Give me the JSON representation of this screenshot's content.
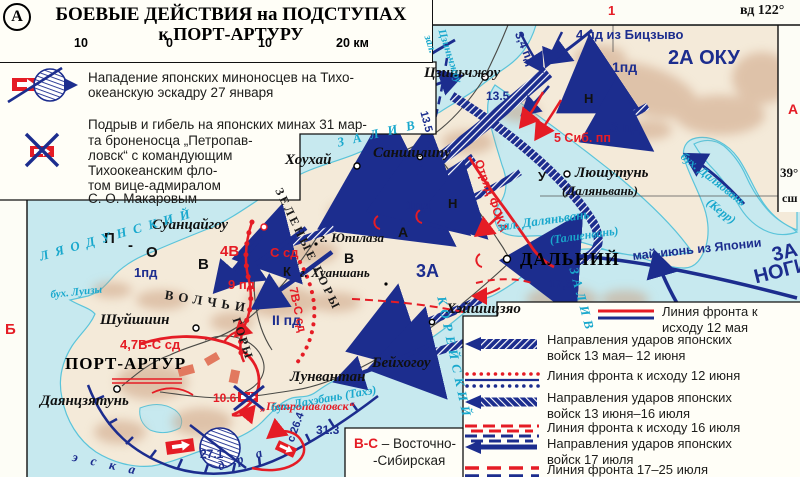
{
  "colors": {
    "red": "#e51c25",
    "navy": "#1c2d8e",
    "cyan": "#19a8cd",
    "water": "#c7e9ef",
    "land": "#f4ead9",
    "relief": "#c99b7a",
    "box": "#fffef7"
  },
  "margins": {
    "top_number": "1",
    "longitude": "вд 122°",
    "right_letter": "А",
    "left_letter": "Б",
    "lat_deg": "39°",
    "lat_dir": "сш"
  },
  "title_box": {
    "badge": "А",
    "line1": "БОЕВЫЕ ДЕЙСТВИЯ на ПОДСТУПАХ",
    "line2": "к ПОРТ-АРТУРУ",
    "scale_ticks": [
      "10",
      "0",
      "10",
      "20 км"
    ]
  },
  "events_box": {
    "items": [
      {
        "icon": "torpedo-attack-icon",
        "lines": [
          "Нападение японских миноносцев на Тихо-",
          "океанскую эскадру 27 января"
        ]
      },
      {
        "icon": "mine-loss-icon",
        "lines": [
          "Подрыв и гибель на японских минах 31 мар-",
          "та броненосца „Петропав-",
          "ловск“ с командующим",
          "Тихоокеанским фло-",
          "том вице-адмиралом",
          "С. О. Макаровым"
        ]
      }
    ]
  },
  "map_labels": [
    {
      "name": "label-4pd-bitszyvo",
      "text": "4 пд из Бицзыво",
      "x": 576,
      "y": 28,
      "cls": "ub",
      "size": 13
    },
    {
      "name": "label-34pd",
      "text": "3,4 пд",
      "x": 524,
      "y": 30,
      "cls": "ub",
      "size": 12,
      "rot": 68
    },
    {
      "name": "label-1pd-north",
      "text": "1пд",
      "x": 612,
      "y": 60,
      "cls": "ub",
      "size": 14
    },
    {
      "name": "label-2a-oku",
      "text": "2А ОКУ",
      "x": 668,
      "y": 48,
      "cls": "ub",
      "size": 20
    },
    {
      "name": "label-3pd",
      "text": "3 пд",
      "x": 610,
      "y": 120,
      "cls": "ub",
      "size": 15
    },
    {
      "name": "label-date-135a",
      "text": "13.5",
      "x": 486,
      "y": 90,
      "cls": "ub",
      "size": 12
    },
    {
      "name": "label-date-135b",
      "text": "13.5",
      "x": 428,
      "y": 110,
      "cls": "ub",
      "size": 11,
      "rot": 75
    },
    {
      "name": "label-1pd-center",
      "text": "1пд",
      "x": 406,
      "y": 198,
      "cls": "ub",
      "size": 14
    },
    {
      "name": "label-3a-center",
      "text": "3А",
      "x": 416,
      "y": 262,
      "cls": "ub",
      "size": 18
    },
    {
      "name": "label-2pd",
      "text": "II пд",
      "x": 272,
      "y": 313,
      "cls": "ub",
      "size": 14
    },
    {
      "name": "label-1pd-west",
      "text": "1пд",
      "x": 134,
      "y": 266,
      "cls": "ub",
      "size": 13
    },
    {
      "name": "label-date-175",
      "text": "17,5",
      "x": 549,
      "y": 278,
      "cls": "ub",
      "size": 12
    },
    {
      "name": "label-date-313",
      "text": "31.3",
      "x": 316,
      "y": 424,
      "cls": "ub",
      "size": 12
    },
    {
      "name": "label-date-271",
      "text": "27.1",
      "x": 200,
      "y": 448,
      "cls": "ub",
      "size": 12
    },
    {
      "name": "label-may-june-japan",
      "text": "май-июнь из Японии",
      "x": 632,
      "y": 250,
      "cls": "ub",
      "size": 12.5,
      "rot": -6
    },
    {
      "name": "label-3a-nogi-1",
      "text": "3А",
      "x": 770,
      "y": 246,
      "cls": "ub",
      "size": 20,
      "rot": -14
    },
    {
      "name": "label-3a-nogi-2",
      "text": "НОГИ",
      "x": 752,
      "y": 268,
      "cls": "ub",
      "size": 20,
      "rot": -14
    },
    {
      "name": "label-s264",
      "text": "с 26.4",
      "x": 286,
      "y": 440,
      "cls": "ub",
      "size": 11,
      "rot": -70
    },
    {
      "name": "label-eskadra-1",
      "text": "э с к а",
      "x": 74,
      "y": 450,
      "cls": "wnavy",
      "size": 13,
      "rot": 12,
      "ls": 5
    },
    {
      "name": "label-eskadra-2",
      "text": "д р а",
      "x": 216,
      "y": 460,
      "cls": "wnavy",
      "size": 13,
      "rot": -18,
      "ls": 5
    },
    {
      "name": "label-5sib",
      "text": "5 Сиб. пп",
      "x": 554,
      "y": 132,
      "cls": "ur",
      "size": 12.5
    },
    {
      "name": "label-otryad-foka",
      "text": "Отряд ФОКА",
      "x": 484,
      "y": 158,
      "cls": "ur",
      "size": 12,
      "rot": 70
    },
    {
      "name": "label-4v",
      "text": "4В",
      "x": 220,
      "y": 244,
      "cls": "ur",
      "size": 15
    },
    {
      "name": "label-ssd",
      "text": "С сд",
      "x": 270,
      "y": 246,
      "cls": "ur",
      "size": 13
    },
    {
      "name": "label-7v-ssd",
      "text": "7В-С сд",
      "x": 299,
      "y": 286,
      "cls": "ur",
      "size": 12,
      "rot": 78
    },
    {
      "name": "label-47v-ssd",
      "text": "4,7В-С сд",
      "x": 120,
      "y": 338,
      "cls": "ur",
      "size": 13
    },
    {
      "name": "label-9pd",
      "text": "9 пд",
      "x": 228,
      "y": 278,
      "cls": "ur",
      "size": 13
    },
    {
      "name": "label-date-106",
      "text": "10.6",
      "x": 213,
      "y": 392,
      "cls": "ur",
      "size": 12
    },
    {
      "name": "label-petropavlovsk",
      "text": "„Петропавловск“",
      "x": 260,
      "y": 400,
      "cls": "uri",
      "size": 12
    },
    {
      "name": "label-tszinchzhou",
      "text": "Цзиньчжоу",
      "x": 424,
      "y": 66,
      "cls": "town",
      "size": 15
    },
    {
      "name": "label-houhai",
      "text": "Хоухай",
      "x": 285,
      "y": 153,
      "cls": "town",
      "size": 15
    },
    {
      "name": "label-sanshilipu",
      "text": "Саншилипу",
      "x": 373,
      "y": 146,
      "cls": "town",
      "size": 15
    },
    {
      "name": "label-lyushutun",
      "text": "Люшутунь",
      "x": 575,
      "y": 166,
      "cls": "town",
      "size": 15
    },
    {
      "name": "label-dalyanvan-alt",
      "text": "(Даляньвань)",
      "x": 562,
      "y": 184,
      "cls": "town",
      "size": 13
    },
    {
      "name": "label-dalny",
      "text": "ДАЛЬНИЙ",
      "x": 520,
      "y": 250,
      "cls": "city",
      "size": 18
    },
    {
      "name": "label-kheyshitszyao",
      "text": "Хэйшицзяо",
      "x": 446,
      "y": 302,
      "cls": "town",
      "size": 15
    },
    {
      "name": "label-beykhogou",
      "text": "Бейхогоу",
      "x": 372,
      "y": 356,
      "cls": "town",
      "size": 15
    },
    {
      "name": "label-lunvantan",
      "text": "Лунвантан",
      "x": 290,
      "y": 370,
      "cls": "town",
      "size": 15
    },
    {
      "name": "label-suantsaygou",
      "text": "Суанцайгоу",
      "x": 152,
      "y": 218,
      "cls": "town",
      "size": 15
    },
    {
      "name": "label-shuyshiin",
      "text": "Шуйшиин",
      "x": 100,
      "y": 313,
      "cls": "town",
      "size": 15
    },
    {
      "name": "label-port-artur",
      "text": "ПОРТ-АРТУР",
      "x": 65,
      "y": 355,
      "cls": "city",
      "size": 17
    },
    {
      "name": "label-dayantszyatun",
      "text": "Даянцзятунь",
      "x": 40,
      "y": 394,
      "cls": "town",
      "size": 15
    },
    {
      "name": "label-yupilaza",
      "text": "г. Юпилаза",
      "x": 320,
      "y": 231,
      "cls": "town",
      "size": 13
    },
    {
      "name": "label-khuanshan",
      "text": "г. Хуаншань",
      "x": 300,
      "y": 266,
      "cls": "town",
      "size": 13
    },
    {
      "name": "label-letter-n1",
      "text": "Н",
      "x": 584,
      "y": 92,
      "cls": "blk",
      "size": 13
    },
    {
      "name": "label-letter-u",
      "text": "У",
      "x": 538,
      "y": 170,
      "cls": "blk",
      "size": 13
    },
    {
      "name": "label-letter-n2",
      "text": "Н",
      "x": 448,
      "y": 197,
      "cls": "blk",
      "size": 13
    },
    {
      "name": "label-letter-a",
      "text": "А",
      "x": 398,
      "y": 225,
      "cls": "blk",
      "size": 14
    },
    {
      "name": "label-letter-v",
      "text": "В",
      "x": 344,
      "y": 251,
      "cls": "blk",
      "size": 14
    },
    {
      "name": "label-letter-k",
      "text": "К",
      "x": 283,
      "y": 265,
      "cls": "blk",
      "size": 13
    },
    {
      "name": "label-pov-p",
      "text": "П",
      "x": 104,
      "y": 231,
      "cls": "blk",
      "size": 15
    },
    {
      "name": "label-pov-dash",
      "text": "-",
      "x": 128,
      "y": 238,
      "cls": "blk",
      "size": 15
    },
    {
      "name": "label-pov-o",
      "text": "О",
      "x": 146,
      "y": 245,
      "cls": "blk",
      "size": 15
    },
    {
      "name": "label-pov-v",
      "text": "В",
      "x": 198,
      "y": 257,
      "cls": "blk",
      "size": 15
    },
    {
      "name": "label-volchi",
      "text": "ВОЛЧЬИ",
      "x": 166,
      "y": 288,
      "cls": "mtn",
      "size": 13,
      "rot": 9,
      "ls": 5
    },
    {
      "name": "label-gory",
      "text": "ГОРЫ",
      "x": 242,
      "y": 316,
      "cls": "mtn",
      "size": 12,
      "rot": 72,
      "ls": 2
    },
    {
      "name": "label-zelenye-gory",
      "text": "ЗЕЛЕНЫЕ ГОРЫ",
      "x": 284,
      "y": 186,
      "cls": "mtn",
      "size": 12,
      "rot": 64,
      "ls": 3
    },
    {
      "name": "label-zal-tszinchzhou-1",
      "text": "зал.",
      "x": 432,
      "y": 34,
      "cls": "water",
      "size": 11,
      "rot": 72
    },
    {
      "name": "label-zal-tszinchzhou-2",
      "text": "Цзиньчжоу",
      "x": 446,
      "y": 28,
      "cls": "water",
      "size": 11,
      "rot": 72
    },
    {
      "name": "label-zaliv-liaodun",
      "text": "ЗАЛИВ",
      "x": 336,
      "y": 136,
      "cls": "water",
      "size": 13,
      "rot": -13,
      "ls": 9
    },
    {
      "name": "label-lyaodunskiy",
      "text": "ЛЯОДУНСКИЙ",
      "x": 38,
      "y": 250,
      "cls": "water",
      "size": 13,
      "rot": -16,
      "ls": 7
    },
    {
      "name": "label-bukh-luizy",
      "text": "бух. Луизы",
      "x": 50,
      "y": 290,
      "cls": "water",
      "size": 11,
      "rot": -6
    },
    {
      "name": "label-zal-dalyanvan",
      "text": "зал. Даляньвань",
      "x": 497,
      "y": 220,
      "cls": "water",
      "size": 13,
      "rot": -8
    },
    {
      "name": "label-talienvan",
      "text": "(Талиенвань)",
      "x": 549,
      "y": 234,
      "cls": "water",
      "size": 12,
      "rot": -8
    },
    {
      "name": "label-bukh-dalyaovan",
      "text": "бух. Даляовань",
      "x": 686,
      "y": 150,
      "cls": "water",
      "size": 12,
      "rot": 38
    },
    {
      "name": "label-kerr",
      "text": "(Керр)",
      "x": 712,
      "y": 196,
      "cls": "water",
      "size": 12,
      "rot": 38
    },
    {
      "name": "label-bukh-dakhebani",
      "text": "бух. Дахэбань (Тахэ)",
      "x": 270,
      "y": 402,
      "cls": "water",
      "size": 12,
      "rot": -10
    },
    {
      "name": "label-koreyskiy",
      "text": "КОРЕЙСКИЙ",
      "x": 448,
      "y": 295,
      "cls": "water",
      "size": 13,
      "rot": 78,
      "ls": 5
    },
    {
      "name": "label-zaliv-korea",
      "text": "ЗАЛИВ",
      "x": 580,
      "y": 266,
      "cls": "water",
      "size": 13,
      "rot": 75,
      "ls": 5
    }
  ],
  "legend_box": {
    "items": [
      {
        "symbol": "front-solid",
        "indent": true,
        "lines": [
          "Линия фронта к",
          "исходу 12 мая"
        ]
      },
      {
        "symbol": "arrow-hatch1",
        "lines": [
          "Направления ударов японских",
          "войск 13 мая– 12 июня"
        ]
      },
      {
        "symbol": "front-dotted",
        "lines": [
          "Линия фронта к исходу 12 июня"
        ]
      },
      {
        "symbol": "arrow-hatch2",
        "lines": [
          "Направления ударов японских",
          "войск 13 июня–16 июля"
        ]
      },
      {
        "symbol": "front-dashed",
        "lines": [
          "Линия фронта к исходу 16 июля"
        ]
      },
      {
        "symbol": "arrow-solid",
        "lines": [
          "Направления ударов японских",
          "войск 17 июля"
        ]
      },
      {
        "symbol": "front-longdash",
        "lines": [
          "Линия фронта 17–25 июля"
        ]
      }
    ]
  },
  "note_box": {
    "abbr": "В-С",
    "rest": "– Восточно-",
    "rest2": "-Сибирская"
  }
}
